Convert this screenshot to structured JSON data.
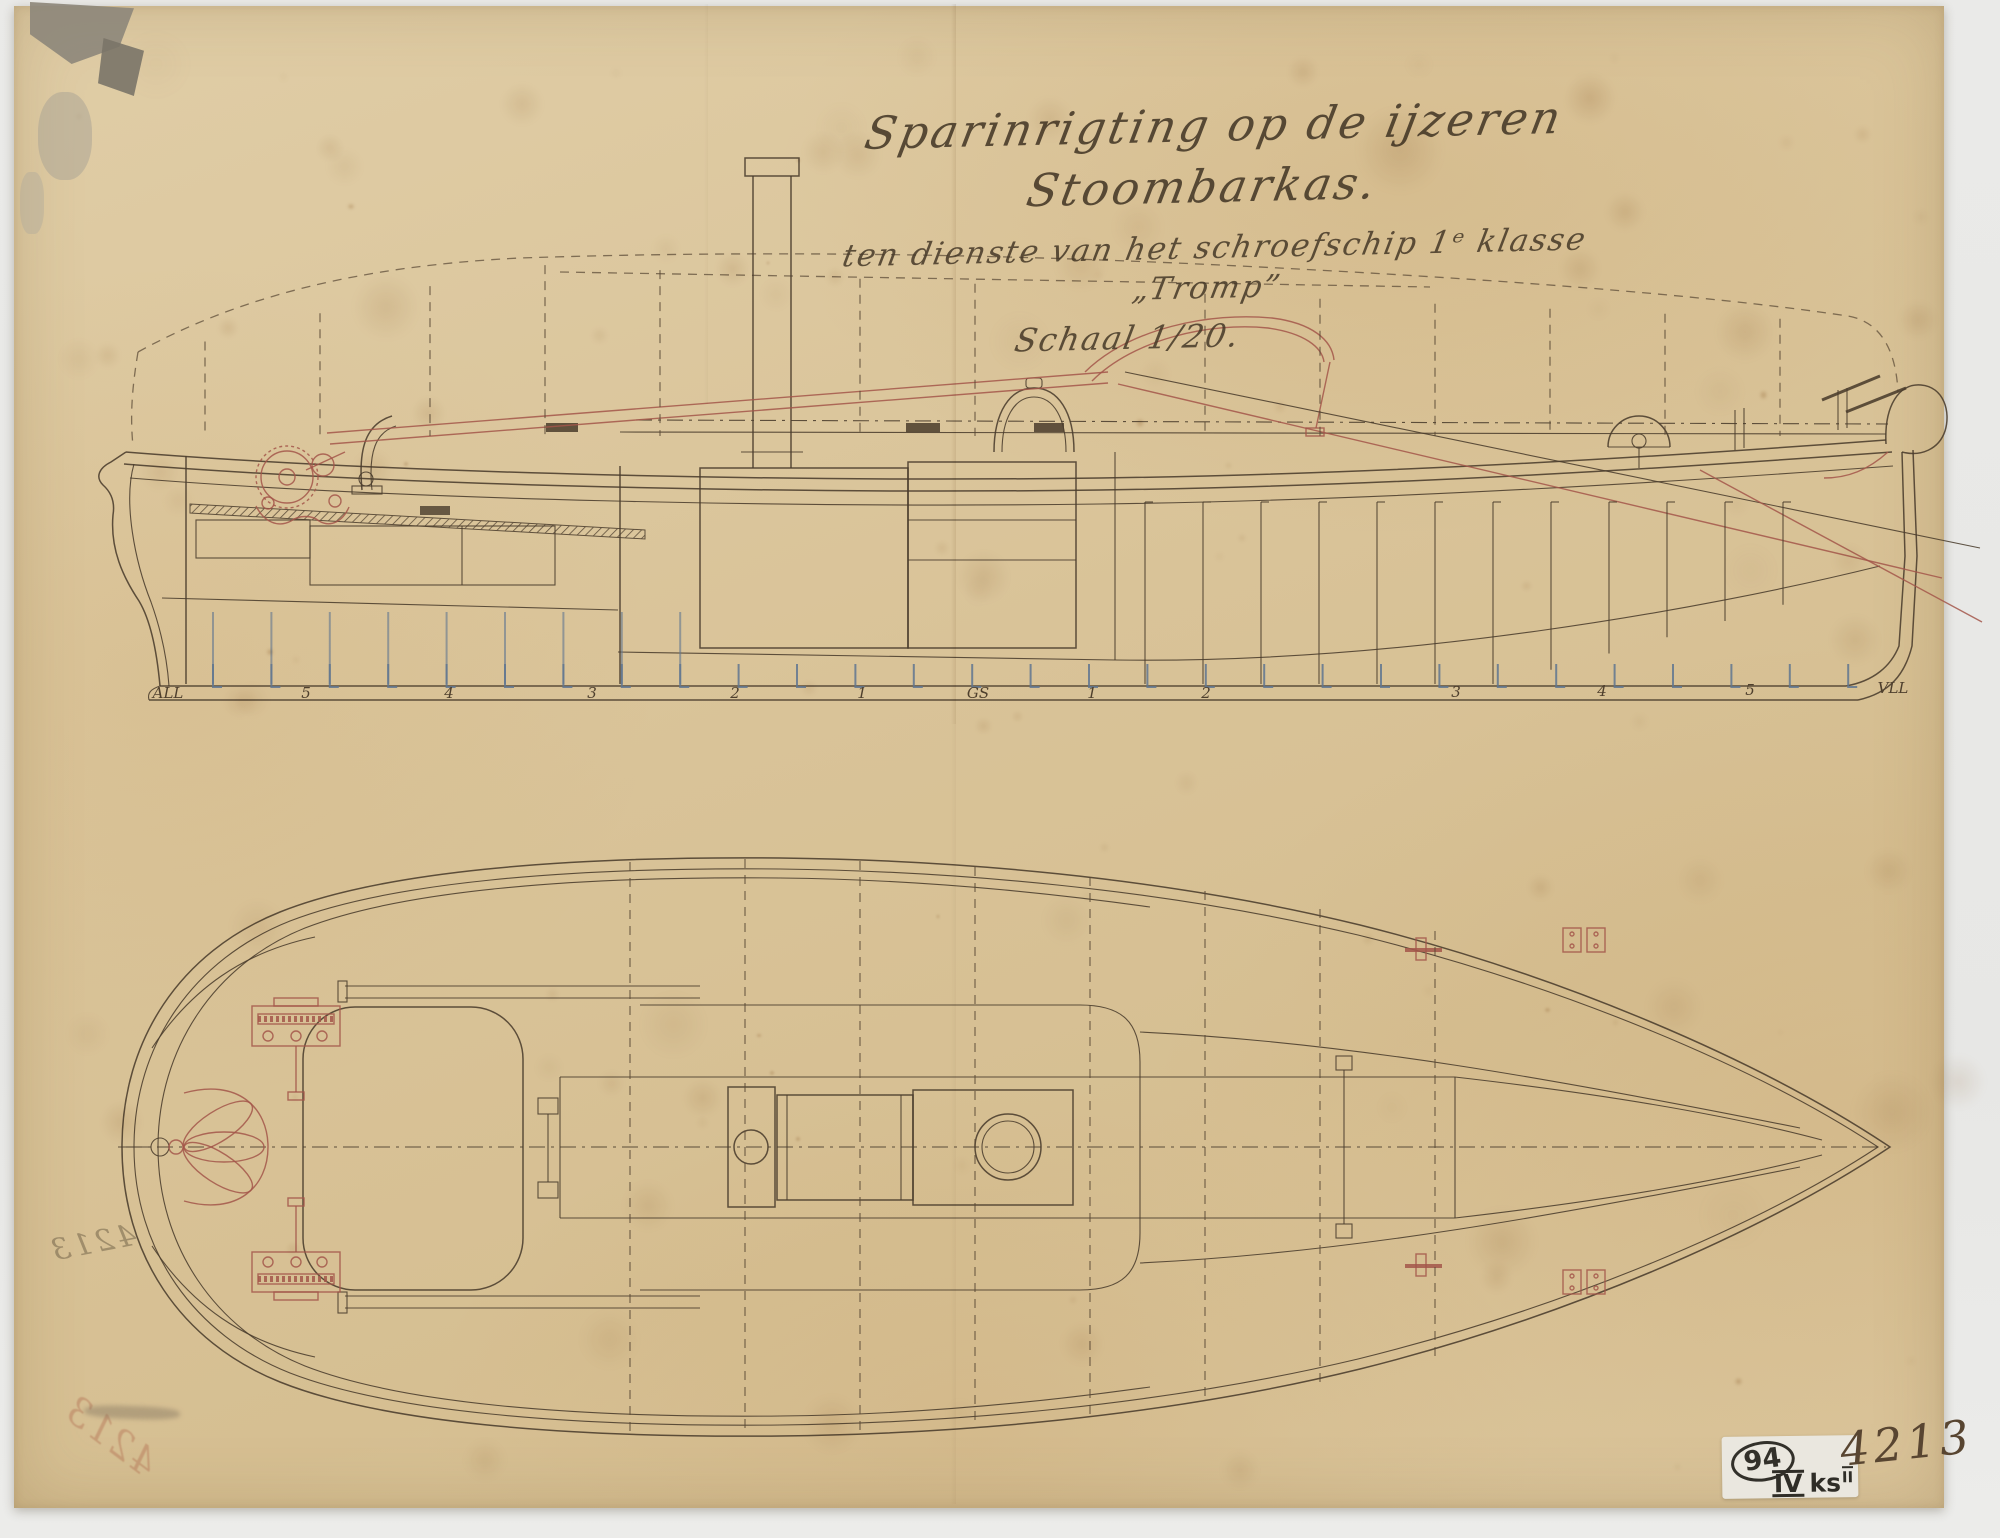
{
  "artwork": {
    "title_line1": "Sparinrigting op de ijzeren Stoombarkas.",
    "title_line2": "ten dienste van het schroefschip 1ᵉ klasse „Tromp”",
    "title_line3": "Schaal 1/20.",
    "inventory_number": "4213",
    "archive_label": {
      "circled_number": "94",
      "class_roman": "IV",
      "class_letters": "ks",
      "class_sup": "II"
    },
    "bleedthrough_pencil": "4213",
    "bleedthrough_red": "4213"
  },
  "side_view": {
    "stations": [
      {
        "text": "ALL",
        "x": 168,
        "y": 698
      },
      {
        "text": "5",
        "x": 306,
        "y": 698
      },
      {
        "text": "4",
        "x": 449,
        "y": 698
      },
      {
        "text": "3",
        "x": 592,
        "y": 698
      },
      {
        "text": "2",
        "x": 735,
        "y": 698
      },
      {
        "text": "1",
        "x": 862,
        "y": 698
      },
      {
        "text": "GS",
        "x": 978,
        "y": 698
      },
      {
        "text": "1",
        "x": 1092,
        "y": 698
      },
      {
        "text": "2",
        "x": 1206,
        "y": 698
      },
      {
        "text": "3",
        "x": 1456,
        "y": 697
      },
      {
        "text": "4",
        "x": 1602,
        "y": 696
      },
      {
        "text": "5",
        "x": 1750,
        "y": 695
      },
      {
        "text": "VLL",
        "x": 1893,
        "y": 693
      }
    ]
  },
  "colors": {
    "paper": "#d9c398",
    "ink": "#4a3c2c",
    "red_ink": "#a3564a",
    "frame_blue": "#5f7590",
    "backdrop": "#e9e9e7"
  }
}
